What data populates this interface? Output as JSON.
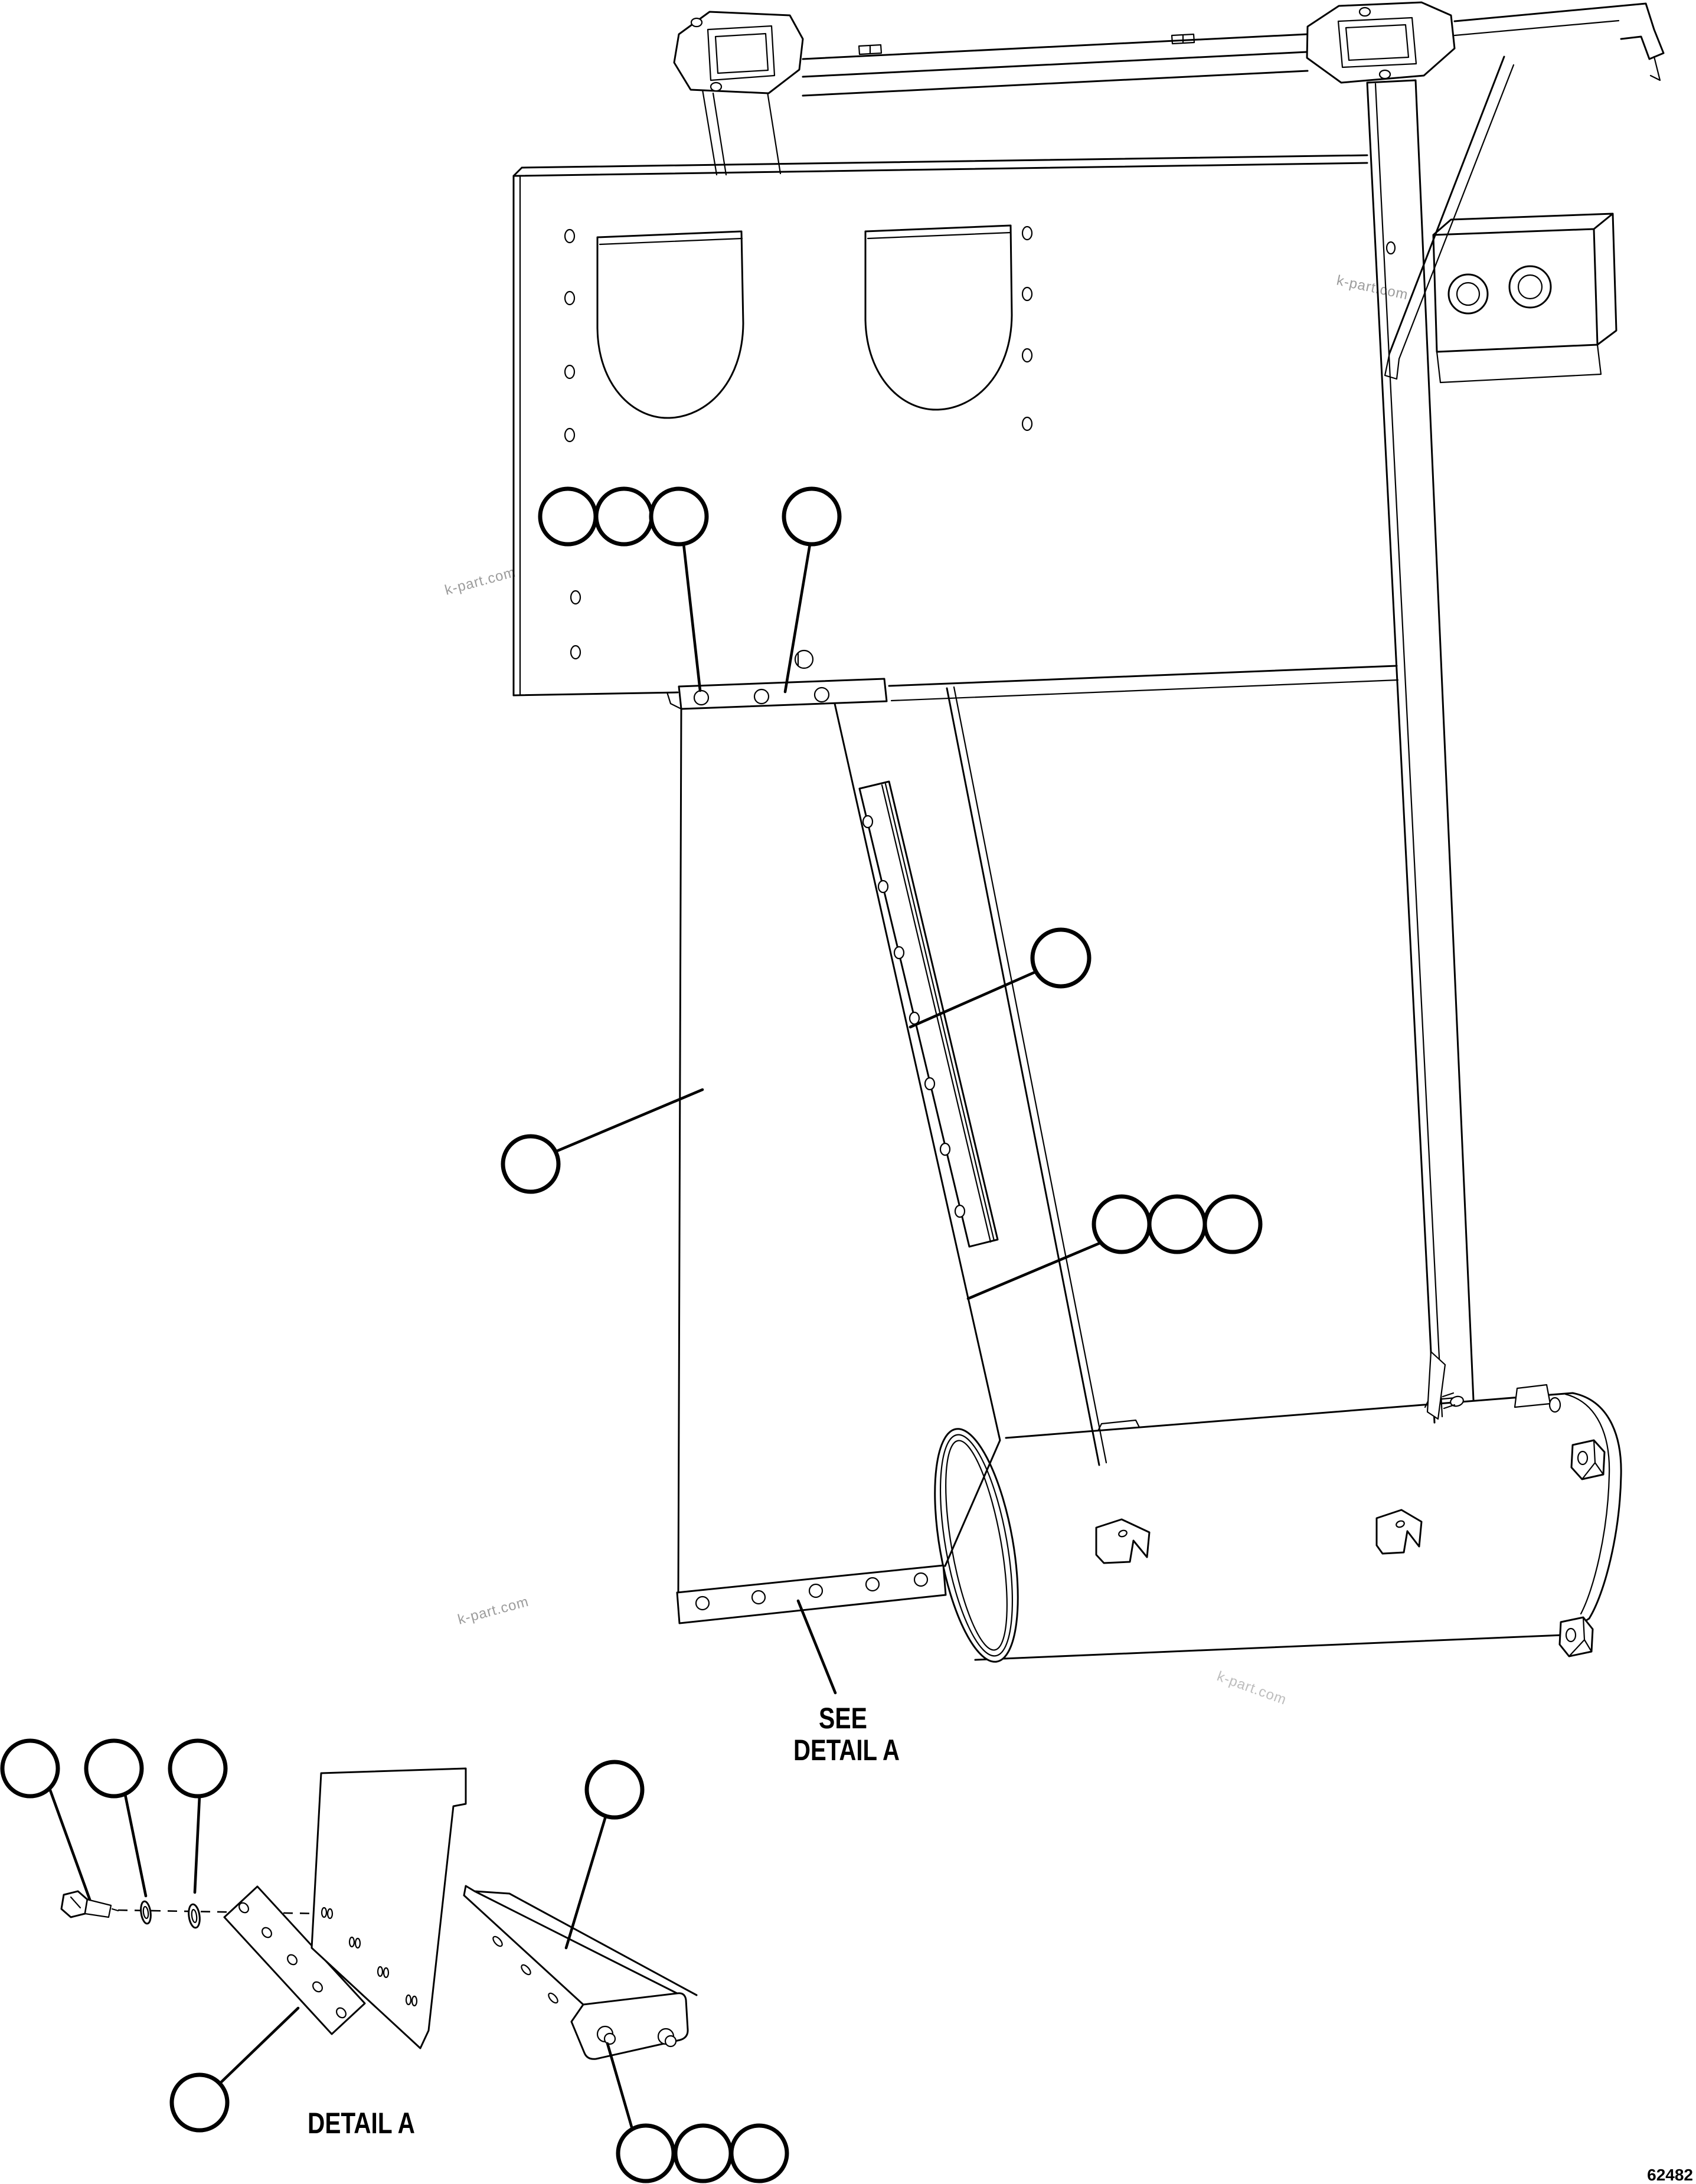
{
  "labels": {
    "see_detail_line1": "SEE",
    "see_detail_line2": "DETAIL A",
    "detail_caption": "DETAIL A",
    "drawing_number": "62482"
  },
  "watermarks": [
    {
      "text": "k-part.com"
    },
    {
      "text": "k-part.com"
    },
    {
      "text": "k-part.com"
    },
    {
      "text": "k-part.com"
    }
  ],
  "colors": {
    "background": "#ffffff",
    "line": "#000000",
    "watermark": "#9c9c9c",
    "watermark_light": "#bdbdbd"
  },
  "callouts": {
    "style": "empty balloon (part number hidden)",
    "balloon_count": 16
  }
}
